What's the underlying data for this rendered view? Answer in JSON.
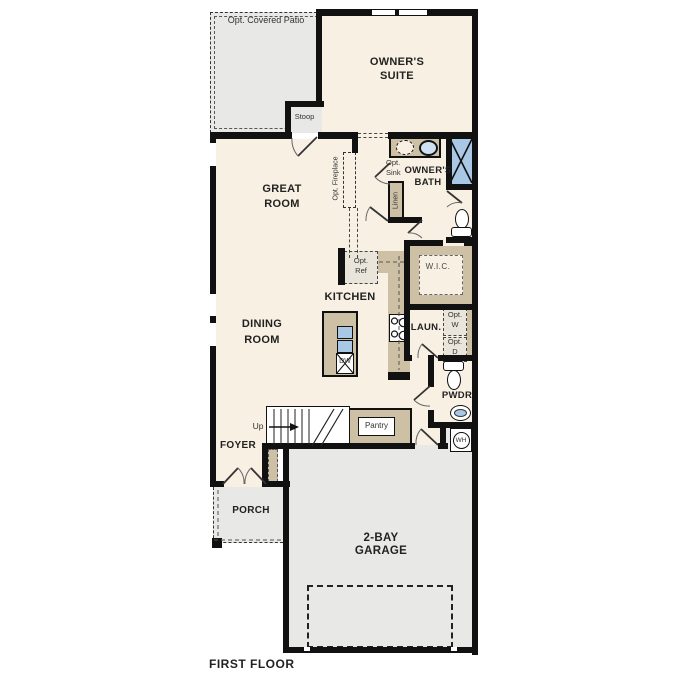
{
  "title": "FIRST FLOOR",
  "rooms": {
    "patio": "Opt. Covered Patio",
    "stoop": "Stoop",
    "suite": [
      "OWNER'S",
      "SUITE"
    ],
    "great": [
      "GREAT",
      "ROOM"
    ],
    "dining": [
      "DINING",
      "ROOM"
    ],
    "kitchen": "KITCHEN",
    "bath": [
      "OWNER'S",
      "BATH"
    ],
    "wic": "W.I.C.",
    "laundry": "LAUN.",
    "pwdr": "PWDR",
    "foyer": "FOYER",
    "porch": "PORCH",
    "garage": [
      "2-BAY",
      "GARAGE"
    ],
    "pantry": "Pantry",
    "linen": "Linen",
    "stairs_up": "Up"
  },
  "fixtures": {
    "opt_sink": [
      "Opt.",
      "Sink"
    ],
    "opt_ref": [
      "Opt.",
      "Ref"
    ],
    "opt_w": [
      "Opt.",
      "W"
    ],
    "opt_d": [
      "Opt.",
      "D"
    ],
    "opt_fireplace": "Opt. Fireplace",
    "dishwasher": "DW",
    "water_heater": "WH"
  },
  "colors": {
    "floor": "#f7f0e3",
    "outdoor": "#e8e8e6",
    "cabinet": "#cdc0a5",
    "wall": "#111111",
    "water_blue": "#a9c8e6",
    "text": "#222222"
  }
}
